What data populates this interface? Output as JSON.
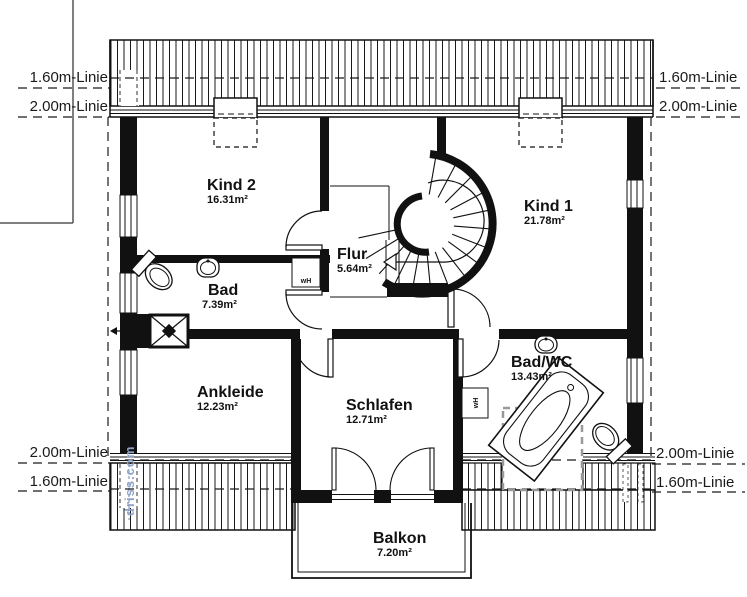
{
  "drawing": {
    "watermark": "driss.com",
    "height_lines": {
      "l160": "1.60m-Linie",
      "l200": "2.00m-Linie"
    },
    "rooms": {
      "kind2": {
        "name": "Kind 2",
        "area": "16.31m²"
      },
      "kind1": {
        "name": "Kind 1",
        "area": "21.78m²"
      },
      "flur": {
        "name": "Flur",
        "area": "5.64m²"
      },
      "bad": {
        "name": "Bad",
        "area": "7.39m²"
      },
      "ankleide": {
        "name": "Ankleide",
        "area": "12.23m²"
      },
      "schlafen": {
        "name": "Schlafen",
        "area": "12.71m²"
      },
      "badwc": {
        "name": "Bad/WC",
        "area": "13.43m²"
      },
      "balkon": {
        "name": "Balkon",
        "area": "7.20m²"
      }
    },
    "fixtures": {
      "wall_heater": "wH"
    },
    "colors": {
      "wall": "#111111",
      "dash_zone": "#999999",
      "watermark": "#8fa3c8"
    }
  }
}
